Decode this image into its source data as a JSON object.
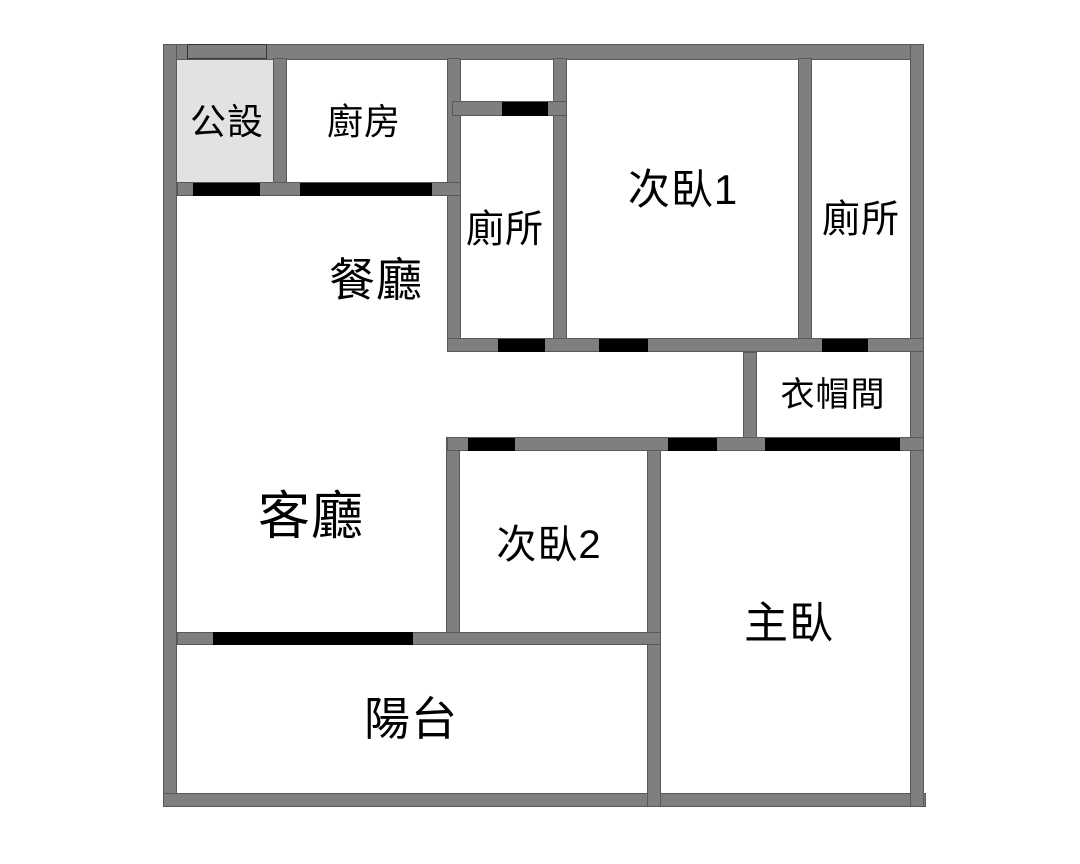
{
  "meta": {
    "title": "Apartment floor plan",
    "width": 1080,
    "height": 864
  },
  "colors": {
    "background": "#ffffff",
    "wall": "#7f7f7f",
    "door": "#000000",
    "public_area_fill": "#e2e2e2",
    "label_text": "#000000"
  },
  "rooms": [
    {
      "id": "public",
      "label": "公設",
      "cx": 227,
      "cy": 122,
      "font_size": 36
    },
    {
      "id": "kitchen",
      "label": "廚房",
      "cx": 364,
      "cy": 122,
      "font_size": 36
    },
    {
      "id": "toilet-upper-left",
      "label": "廁所",
      "cx": 505,
      "cy": 230,
      "font_size": 38
    },
    {
      "id": "bedroom-1",
      "label": "次臥1",
      "cx": 683,
      "cy": 190,
      "font_size": 42
    },
    {
      "id": "toilet-upper-right",
      "label": "廁所",
      "cx": 861,
      "cy": 220,
      "font_size": 38
    },
    {
      "id": "dining",
      "label": "餐廳",
      "cx": 376,
      "cy": 280,
      "font_size": 46
    },
    {
      "id": "closet",
      "label": "衣帽間",
      "cx": 833,
      "cy": 395,
      "font_size": 34
    },
    {
      "id": "living",
      "label": "客廳",
      "cx": 311,
      "cy": 517,
      "font_size": 52
    },
    {
      "id": "bedroom-2",
      "label": "次臥2",
      "cx": 549,
      "cy": 545,
      "font_size": 40
    },
    {
      "id": "master",
      "label": "主臥",
      "cx": 789,
      "cy": 624,
      "font_size": 44
    },
    {
      "id": "balcony",
      "label": "陽台",
      "cx": 411,
      "cy": 719,
      "font_size": 46
    }
  ],
  "areas": [
    {
      "id": "public-area-fill",
      "x": 177,
      "y": 60,
      "w": 96,
      "h": 123,
      "fill": "public_area_fill"
    }
  ],
  "walls": [
    {
      "id": "outer-top",
      "x": 163,
      "y": 44,
      "w": 761,
      "h": 16
    },
    {
      "id": "outer-left",
      "x": 163,
      "y": 44,
      "w": 14,
      "h": 763
    },
    {
      "id": "outer-bottom",
      "x": 163,
      "y": 793,
      "w": 763,
      "h": 14
    },
    {
      "id": "outer-right",
      "x": 910,
      "y": 44,
      "w": 14,
      "h": 763
    },
    {
      "id": "partition-public-kitchen",
      "x": 273,
      "y": 58,
      "w": 14,
      "h": 138
    },
    {
      "id": "wall-kitchen-right",
      "x": 447,
      "y": 58,
      "w": 14,
      "h": 294
    },
    {
      "id": "wall-toilet-left-right",
      "x": 553,
      "y": 58,
      "w": 14,
      "h": 294
    },
    {
      "id": "wall-bedroom1-right",
      "x": 798,
      "y": 58,
      "w": 14,
      "h": 294
    },
    {
      "id": "wall-closet-left",
      "x": 743,
      "y": 352,
      "w": 14,
      "h": 99
    },
    {
      "id": "wall-bedroom2-left",
      "x": 446,
      "y": 437,
      "w": 14,
      "h": 208
    },
    {
      "id": "wall-master-left",
      "x": 647,
      "y": 437,
      "w": 14,
      "h": 370
    },
    {
      "id": "wall-public-kitchen-bottom",
      "x": 177,
      "y": 182,
      "w": 284,
      "h": 14
    },
    {
      "id": "wall-toilet-left-top",
      "x": 452,
      "y": 101,
      "w": 115,
      "h": 15
    },
    {
      "id": "wall-corridor-upper",
      "x": 447,
      "y": 338,
      "w": 477,
      "h": 14
    },
    {
      "id": "wall-corridor-lower",
      "x": 447,
      "y": 437,
      "w": 477,
      "h": 14
    },
    {
      "id": "wall-balcony",
      "x": 177,
      "y": 632,
      "w": 484,
      "h": 13
    }
  ],
  "trims": [
    {
      "id": "top-wall-panel",
      "x": 187,
      "y": 44,
      "w": 80,
      "h": 15
    }
  ],
  "doors": [
    {
      "id": "door-public",
      "x": 193,
      "y": 183,
      "w": 67,
      "h": 13
    },
    {
      "id": "door-kitchen",
      "x": 300,
      "y": 183,
      "w": 132,
      "h": 13
    },
    {
      "id": "door-toilet-left-top",
      "x": 502,
      "y": 102,
      "w": 46,
      "h": 14
    },
    {
      "id": "door-toilet-left",
      "x": 498,
      "y": 339,
      "w": 47,
      "h": 13
    },
    {
      "id": "door-bedroom1",
      "x": 599,
      "y": 339,
      "w": 49,
      "h": 13
    },
    {
      "id": "door-toilet-right",
      "x": 822,
      "y": 339,
      "w": 46,
      "h": 13
    },
    {
      "id": "door-bedroom2",
      "x": 468,
      "y": 438,
      "w": 47,
      "h": 13
    },
    {
      "id": "door-master",
      "x": 668,
      "y": 438,
      "w": 49,
      "h": 13
    },
    {
      "id": "door-closet",
      "x": 765,
      "y": 438,
      "w": 135,
      "h": 13
    },
    {
      "id": "door-balcony",
      "x": 213,
      "y": 632,
      "w": 200,
      "h": 13
    }
  ]
}
